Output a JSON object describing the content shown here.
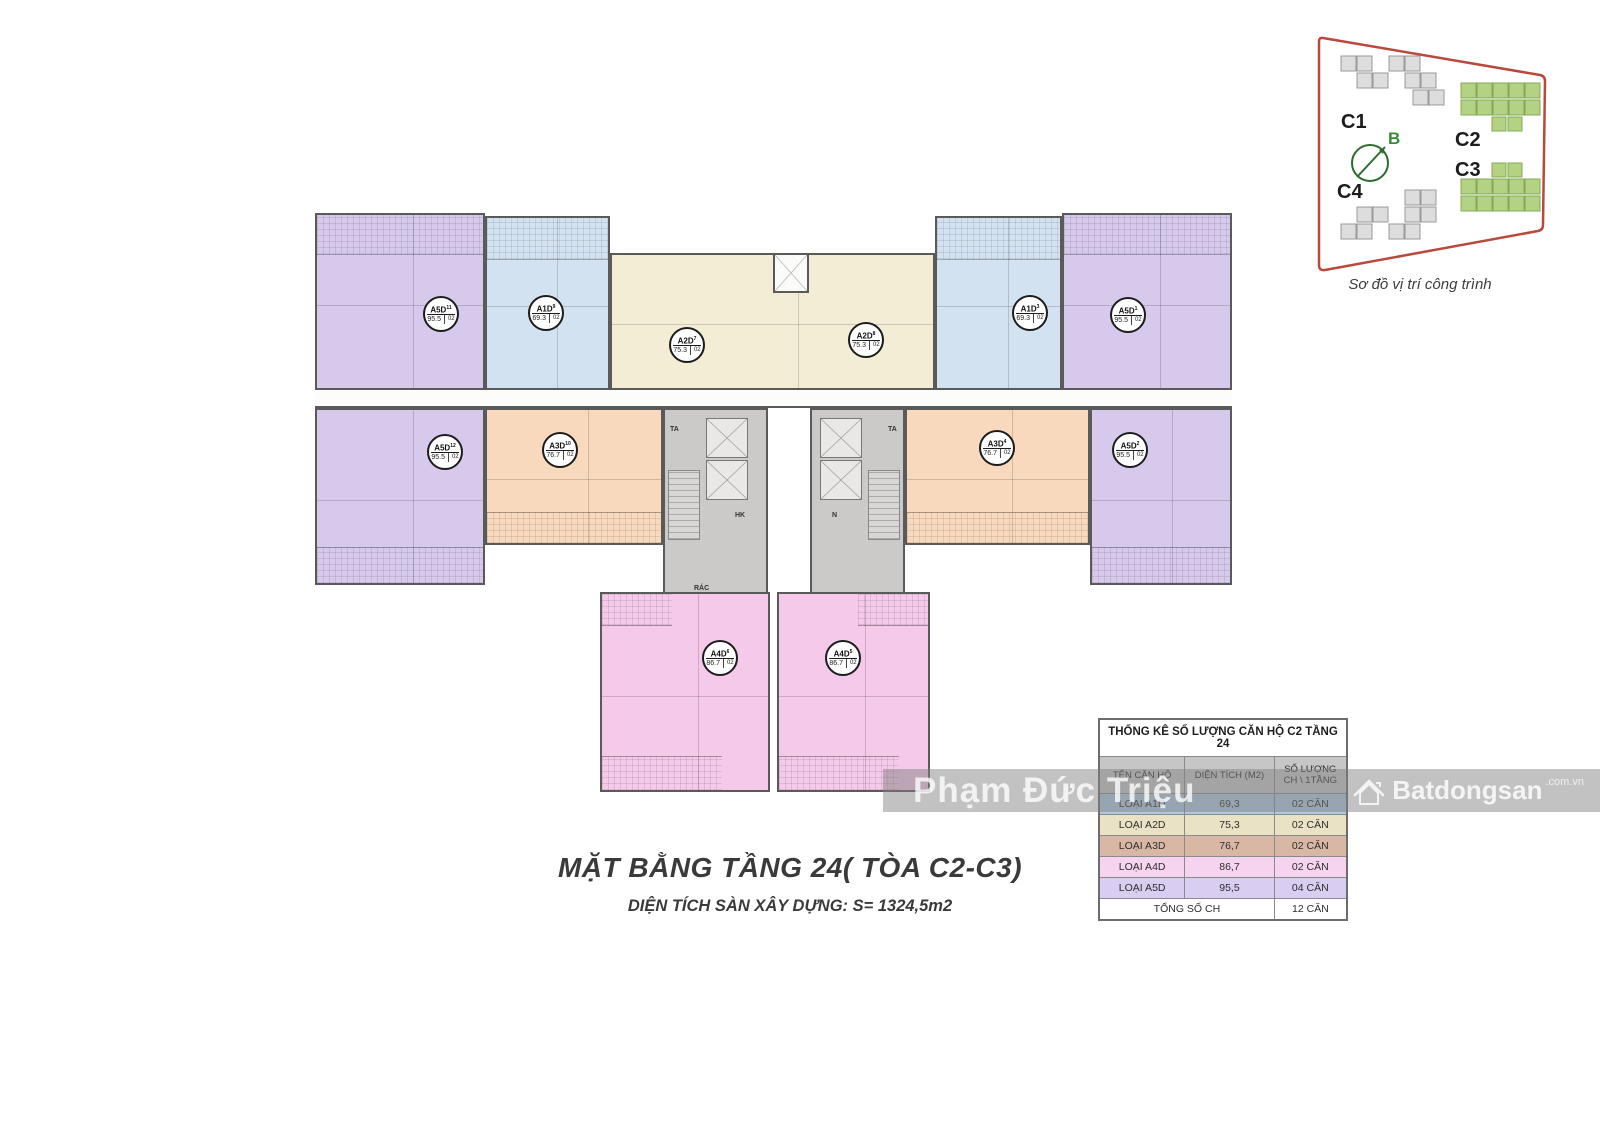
{
  "plan": {
    "title": "MẶT BẰNG TẦNG 24( TÒA C2-C3)",
    "subtitle": "DIỆN TÍCH SÀN XÂY DỰNG: S= 1324,5m2",
    "units": [
      {
        "type": "A5D",
        "index": "11",
        "area": "95.5",
        "count": "02"
      },
      {
        "type": "A1D",
        "index": "9",
        "area": "69.3",
        "count": "02"
      },
      {
        "type": "A2D",
        "index": "7",
        "area": "75.3",
        "count": "02"
      },
      {
        "type": "A2D",
        "index": "8",
        "area": "75.3",
        "count": "02"
      },
      {
        "type": "A1D",
        "index": "3",
        "area": "69.3",
        "count": "02"
      },
      {
        "type": "A5D",
        "index": "1",
        "area": "95.5",
        "count": "02"
      },
      {
        "type": "A5D",
        "index": "12",
        "area": "95.5",
        "count": "02"
      },
      {
        "type": "A3D",
        "index": "10",
        "area": "76.7",
        "count": "02"
      },
      {
        "type": "A3D",
        "index": "4",
        "area": "76.7",
        "count": "02"
      },
      {
        "type": "A5D",
        "index": "2",
        "area": "95.5",
        "count": "02"
      },
      {
        "type": "A4D",
        "index": "6",
        "area": "86.7",
        "count": "02"
      },
      {
        "type": "A4D",
        "index": "5",
        "area": "86.7",
        "count": "02"
      }
    ],
    "core_labels": {
      "ta": "TA",
      "hk": "HK",
      "n": "N",
      "rac": "RÁC"
    }
  },
  "site_map": {
    "caption": "Sơ đồ vị trí công trình",
    "compass_label": "B",
    "buildings": [
      {
        "label": "C1",
        "color": "gray"
      },
      {
        "label": "C2",
        "color": "green"
      },
      {
        "label": "C3",
        "color": "green"
      },
      {
        "label": "C4",
        "color": "gray"
      }
    ]
  },
  "table": {
    "title": "THỐNG KÊ SỐ LƯỢNG CĂN HỘ C2 TẦNG 24",
    "headers": [
      "TÊN CĂN HỘ",
      "DIỆN TÍCH (M2)",
      "SỐ LƯỢNG CH \\ 1TẦNG"
    ],
    "rows": [
      {
        "name": "LOẠI A1D",
        "area": "69,3",
        "count": "02 CĂN",
        "color": "#afc8dc"
      },
      {
        "name": "LOẠI A2D",
        "area": "75,3",
        "count": "02 CĂN",
        "color": "#e9e2c5"
      },
      {
        "name": "LOẠI A3D",
        "area": "76,7",
        "count": "02 CĂN",
        "color": "#d9b7a5"
      },
      {
        "name": "LOẠI A4D",
        "area": "86,7",
        "count": "02 CĂN",
        "color": "#f6d3ee"
      },
      {
        "name": "LOẠI A5D",
        "area": "95,5",
        "count": "04 CĂN",
        "color": "#d9cdf1"
      }
    ],
    "total_label": "TỔNG SỐ CH",
    "total_value": "12 CĂN"
  },
  "watermark": {
    "text": "Phạm Đức Triệu",
    "brand": "Batdongsan",
    "brand_suffix": ".com.vn"
  },
  "colors": {
    "purple": "#d7c9ec",
    "blue": "#d3e2f1",
    "cream": "#f2edd4",
    "orange": "#f8d9be",
    "pink": "#f4c9e9",
    "core_gray": "#cbcac8",
    "wall": "#5a5a5a",
    "site_outline_red": "#b84a3c",
    "building_green": "#b3d284",
    "building_gray": "#dddddd",
    "compass_green": "#2e6b2e"
  }
}
